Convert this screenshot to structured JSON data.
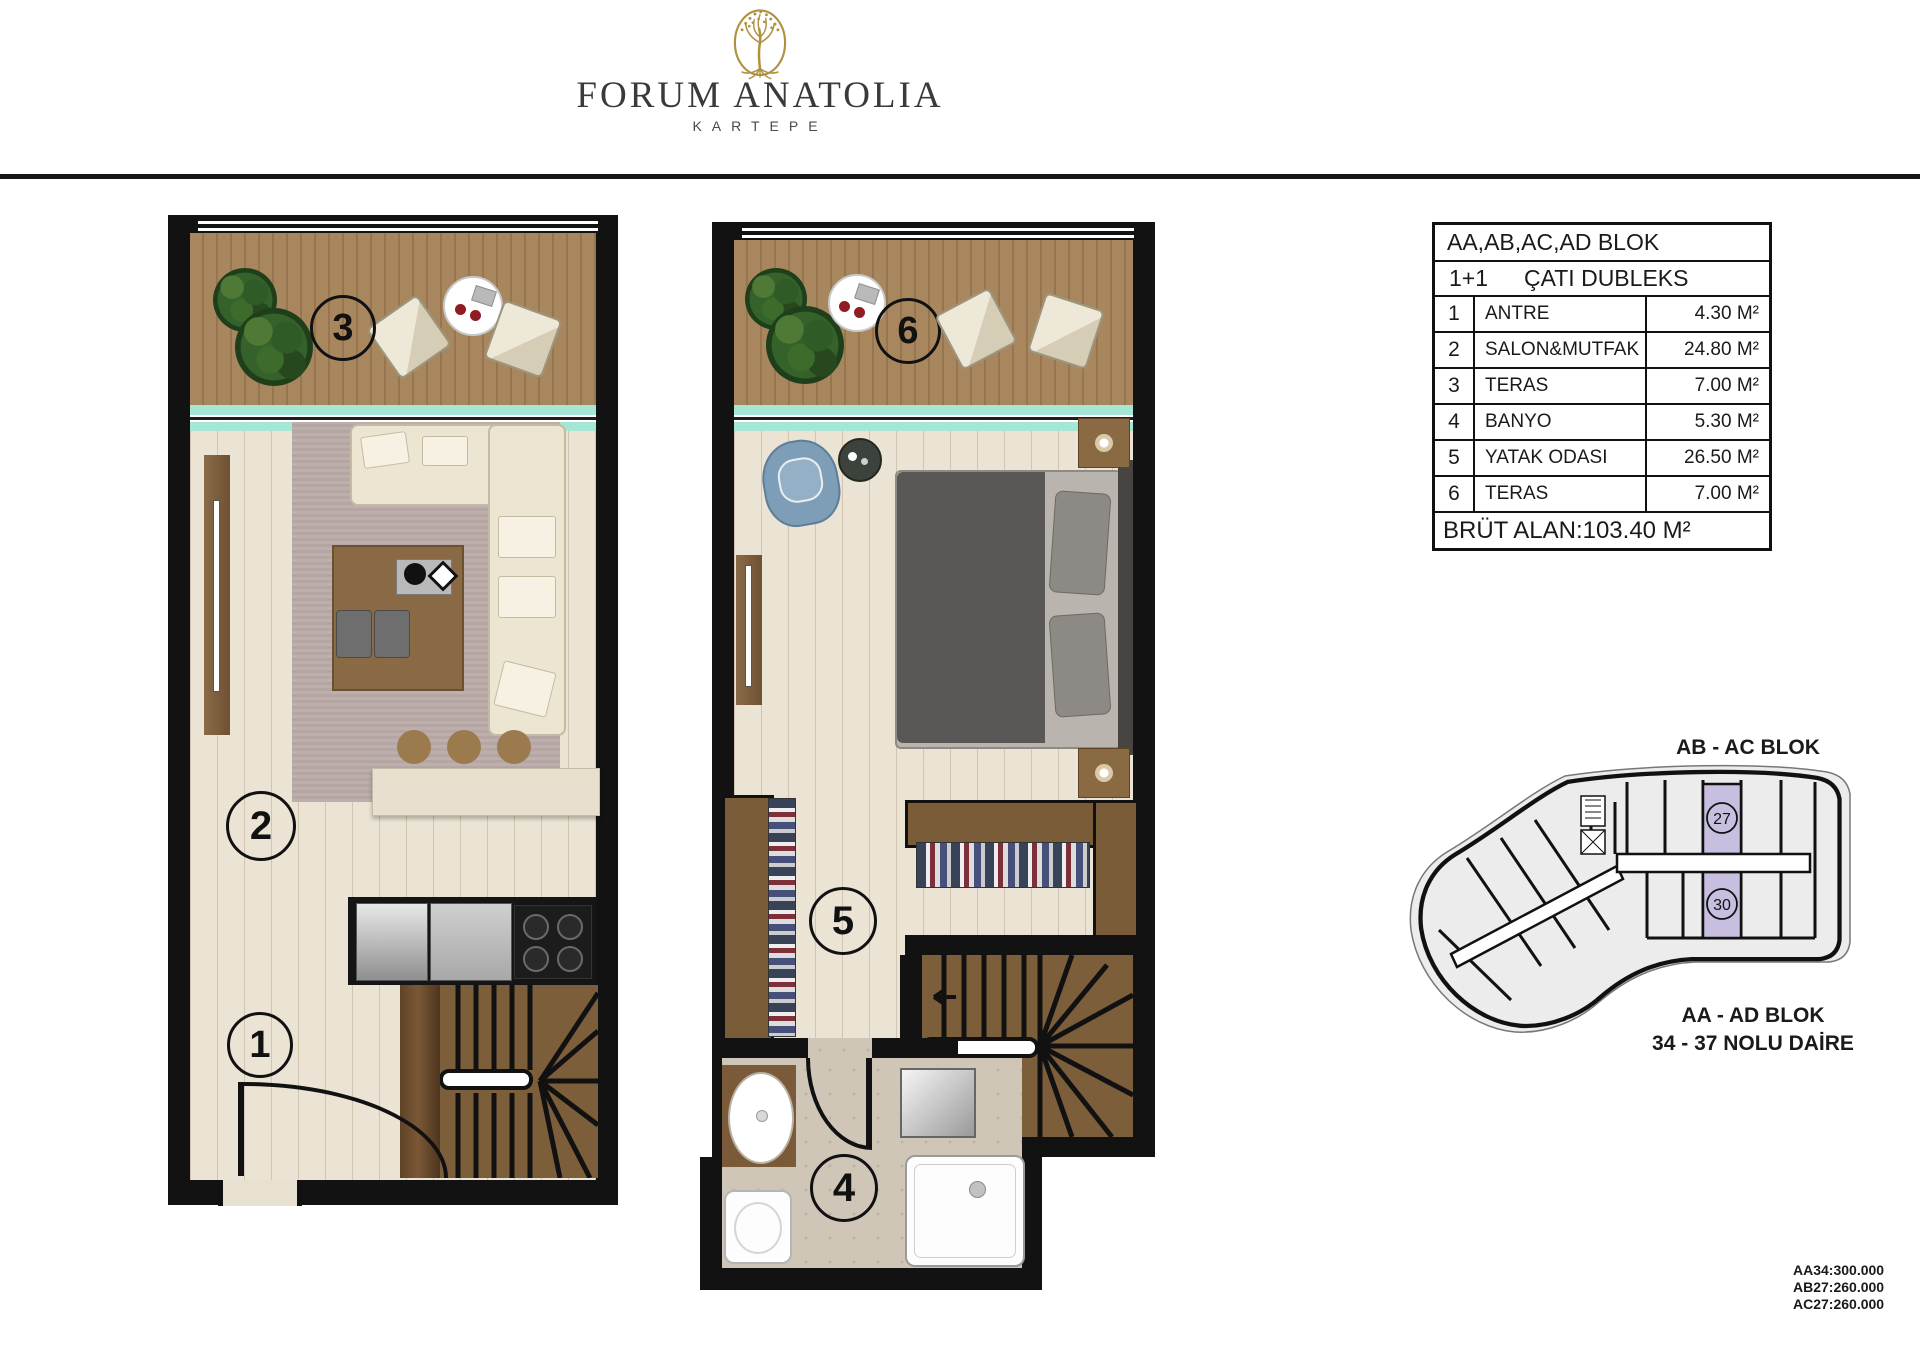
{
  "brand": {
    "title": "FORUM ANATOLIA",
    "subtitle": "KARTEPE"
  },
  "unit_table": {
    "block_header": "AA,AB,AC,AD BLOK",
    "unit_type": "1+1",
    "plan_name": "ÇATI DUBLEKS",
    "rows": [
      {
        "no": "1",
        "name": "ANTRE",
        "area": "4.30 M²"
      },
      {
        "no": "2",
        "name": "SALON&MUTFAK",
        "area": "24.80 M²"
      },
      {
        "no": "3",
        "name": "TERAS",
        "area": "7.00 M²"
      },
      {
        "no": "4",
        "name": "BANYO",
        "area": "5.30 M²"
      },
      {
        "no": "5",
        "name": "YATAK ODASI",
        "area": "26.50 M²"
      },
      {
        "no": "6",
        "name": "TERAS",
        "area": "7.00 M²"
      }
    ],
    "gross_area_label": "BRÜT ALAN",
    "gross_area_value": "103.40 M²"
  },
  "floor_plans": {
    "lower": {
      "labels": {
        "teras": "3",
        "salon": "2",
        "antre": "1"
      }
    },
    "upper": {
      "labels": {
        "teras": "6",
        "yatak": "5",
        "banyo": "4"
      }
    }
  },
  "site_plan": {
    "top_label": "AB - AC BLOK",
    "bottom_label_1": "AA - AD BLOK",
    "bottom_label_2": "34 - 37 NOLU DAİRE",
    "unit_circles": {
      "upper": "27",
      "lower": "30"
    }
  },
  "prices": [
    "AA34:300.000",
    "AB27:260.000",
    "AC27:260.000"
  ],
  "colors": {
    "gold": "#b09140",
    "teal": "#a6e6d4",
    "purple": "#c8bfe0",
    "wall": "#121212",
    "deck": "#a8875f",
    "floor": "#ebe4d4",
    "stair": "#7d5e3b"
  }
}
